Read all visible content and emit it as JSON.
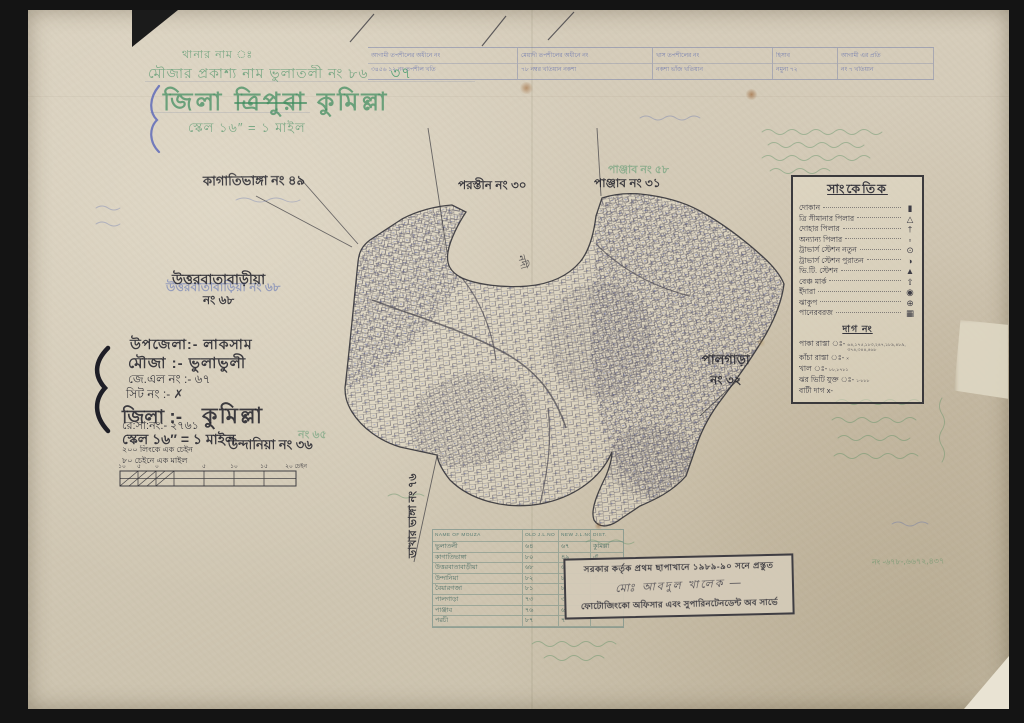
{
  "header": {
    "thana_line": "থানার নাম ঃ",
    "mouza_line": "মৌজার প্রকাশ্য নাম ভুলাতলী নং ৮৬",
    "mouza_added": "৩৭",
    "district_prefix": "জিলা",
    "district_struck": "ত্রিপুরা",
    "district_name": "কুমিল্লা",
    "scale_line": "স্কেল ১৬″ = ১ মাইল"
  },
  "top_table": {
    "cells": [
      {
        "t": "আগামী তপশীলের অধীনে নং",
        "b": "৩৪৫৬ ১২ নং তপশীল খতি"
      },
      {
        "t": "মেয়াদী তপশীলের অধীনে নং",
        "b": "৭৮ নম্বর খতিয়ান নকশা"
      },
      {
        "t": "খাস তপশীলের নং",
        "b": "নকশা ভাঁজ খতিয়ান"
      },
      {
        "t": "হিসাব",
        "b": "নমুনা ৭২"
      },
      {
        "t": "আগামী এর প্রতি",
        "b": "নং ৭ খতিয়ান"
      }
    ]
  },
  "legend": {
    "title": "সাংকেতিক",
    "items": [
      {
        "label": "দোকান",
        "symbol": "▮"
      },
      {
        "label": "ত্রি সীমানার পিলার",
        "symbol": "△"
      },
      {
        "label": "দোহার পিলার",
        "symbol": "†"
      },
      {
        "label": "অন্যান্য পিলার",
        "symbol": "▫"
      },
      {
        "label": "ট্রাভার্স স্টেশন নতুন",
        "symbol": "⊙"
      },
      {
        "label": "ট্রাভার্স স্টেশন পুরাতন",
        "symbol": "◑"
      },
      {
        "label": "ভি.টি. স্টেশন",
        "symbol": "▲"
      },
      {
        "label": "বেঞ্চ মার্ক",
        "symbol": "⇧"
      },
      {
        "label": "ইঁদারা",
        "symbol": "◉"
      },
      {
        "label": "ঝাকুপ",
        "symbol": "⊕"
      },
      {
        "label": "পানেরবরজ",
        "symbol": "▦"
      }
    ],
    "dag_title": "দাগ নং",
    "dag_items": [
      {
        "label": "পাকা রাস্তা ঃ-",
        "value": "৬৪,১৭৫,১৮৩,২৪৭,১৮৯,৪৮৯,৩৭৪,৩৪৪,৪৬৮"
      },
      {
        "label": "কাঁচা রাস্তা ঃ-",
        "value": "×"
      },
      {
        "label": "খাল ঃ-",
        "value": "৮৮,৮৭৮১"
      },
      {
        "label": "ঝর ভিটি যুক্ত ঃ-",
        "value": "১-৮৮৮"
      },
      {
        "label": "বাটী দাগ x-",
        "value": ""
      }
    ]
  },
  "info": {
    "upazila": "উপজেলা:- লাকসাম",
    "mouza": "মৌজা :-  ভুলাভুলী",
    "jl_no": "জে.এল নং :- ৬৭",
    "sheet_no": "সিট নং :- ✗",
    "district_label": "জিলা :-",
    "district_value": "কুমিল্লা",
    "reg_no": "রে:সা:নং:- ২৭৬১",
    "scale": "স্কেল ১৬″ = ১ মাইল",
    "chain1": "২০০ লিংকে এক চেইন",
    "chain2": "৮০ চেইনে এক মাইল",
    "scalebar": [
      "১০",
      "৫",
      "০",
      "৫",
      "১০",
      "১৫",
      "২০ চেইন"
    ]
  },
  "map": {
    "labels": {
      "kagati": "কাগাতিভাঙ্গা নং ৪৯",
      "porotin": "পরস্তীন নং ৩০",
      "panjab": "পাঞ্জাব নং ৩১",
      "panjab_green": "পাঞ্জাব নং ৫৮",
      "uttarbata": "উত্তরবাতাবাড়ীয়া",
      "uttarbata_no": "নং ৬৮",
      "uttarbata_blue": "উত্তরবাতাবাড়িয়া নং ৬৮",
      "palgara": "পালগাড়া",
      "palgara_no": "নং ৩২",
      "undania": "উন্দানিয়া নং ৩৬",
      "undania_green": "নং ৬৫",
      "dakhar": "ডাখার ভাঙ্গা নং ৭৬",
      "river": "নদী"
    }
  },
  "bottom_table": {
    "headers": [
      "NAME OF MOUZA",
      "OLD J.L.NO",
      "NEW J.L.NO",
      "DIST."
    ],
    "rows": [
      [
        "ভুলাতলী",
        "৬৪",
        "৬৭",
        "কুমিল্লা"
      ],
      [
        "কাগাতিভাঙ্গা",
        "৮০",
        "৪৯",
        "ঐ"
      ],
      [
        "উত্তরবাতাবাড়ীয়া",
        "৬৮",
        "৬৮",
        "ঐ"
      ],
      [
        "উন্দানিয়া",
        "৮২",
        "৮",
        "ঐ"
      ],
      [
        "বৈয়ারগজা",
        "৮১",
        "৮",
        ""
      ],
      [
        "পালগাড়া",
        "৭৩",
        "৩",
        ""
      ],
      [
        "পাঞ্জাব",
        "৭৬",
        "৬",
        ""
      ],
      [
        "পরচী",
        "৮৭",
        "৭",
        ""
      ]
    ]
  },
  "stamp": {
    "line1": "সরকার কর্তৃক প্রথম ছাপাখানে ১৯৮৯-৯০ সনে প্রস্তুত",
    "signature": "মোঃ আবদুল খালেক —",
    "line3": "ফোটোজিংকো অফিসার এবং সুপারিনটেনডেন্ট অব সার্ভে"
  },
  "annotations": {
    "right_numbers": "নং -৬৭৮-,৬৬৭২,৪৩৭"
  }
}
